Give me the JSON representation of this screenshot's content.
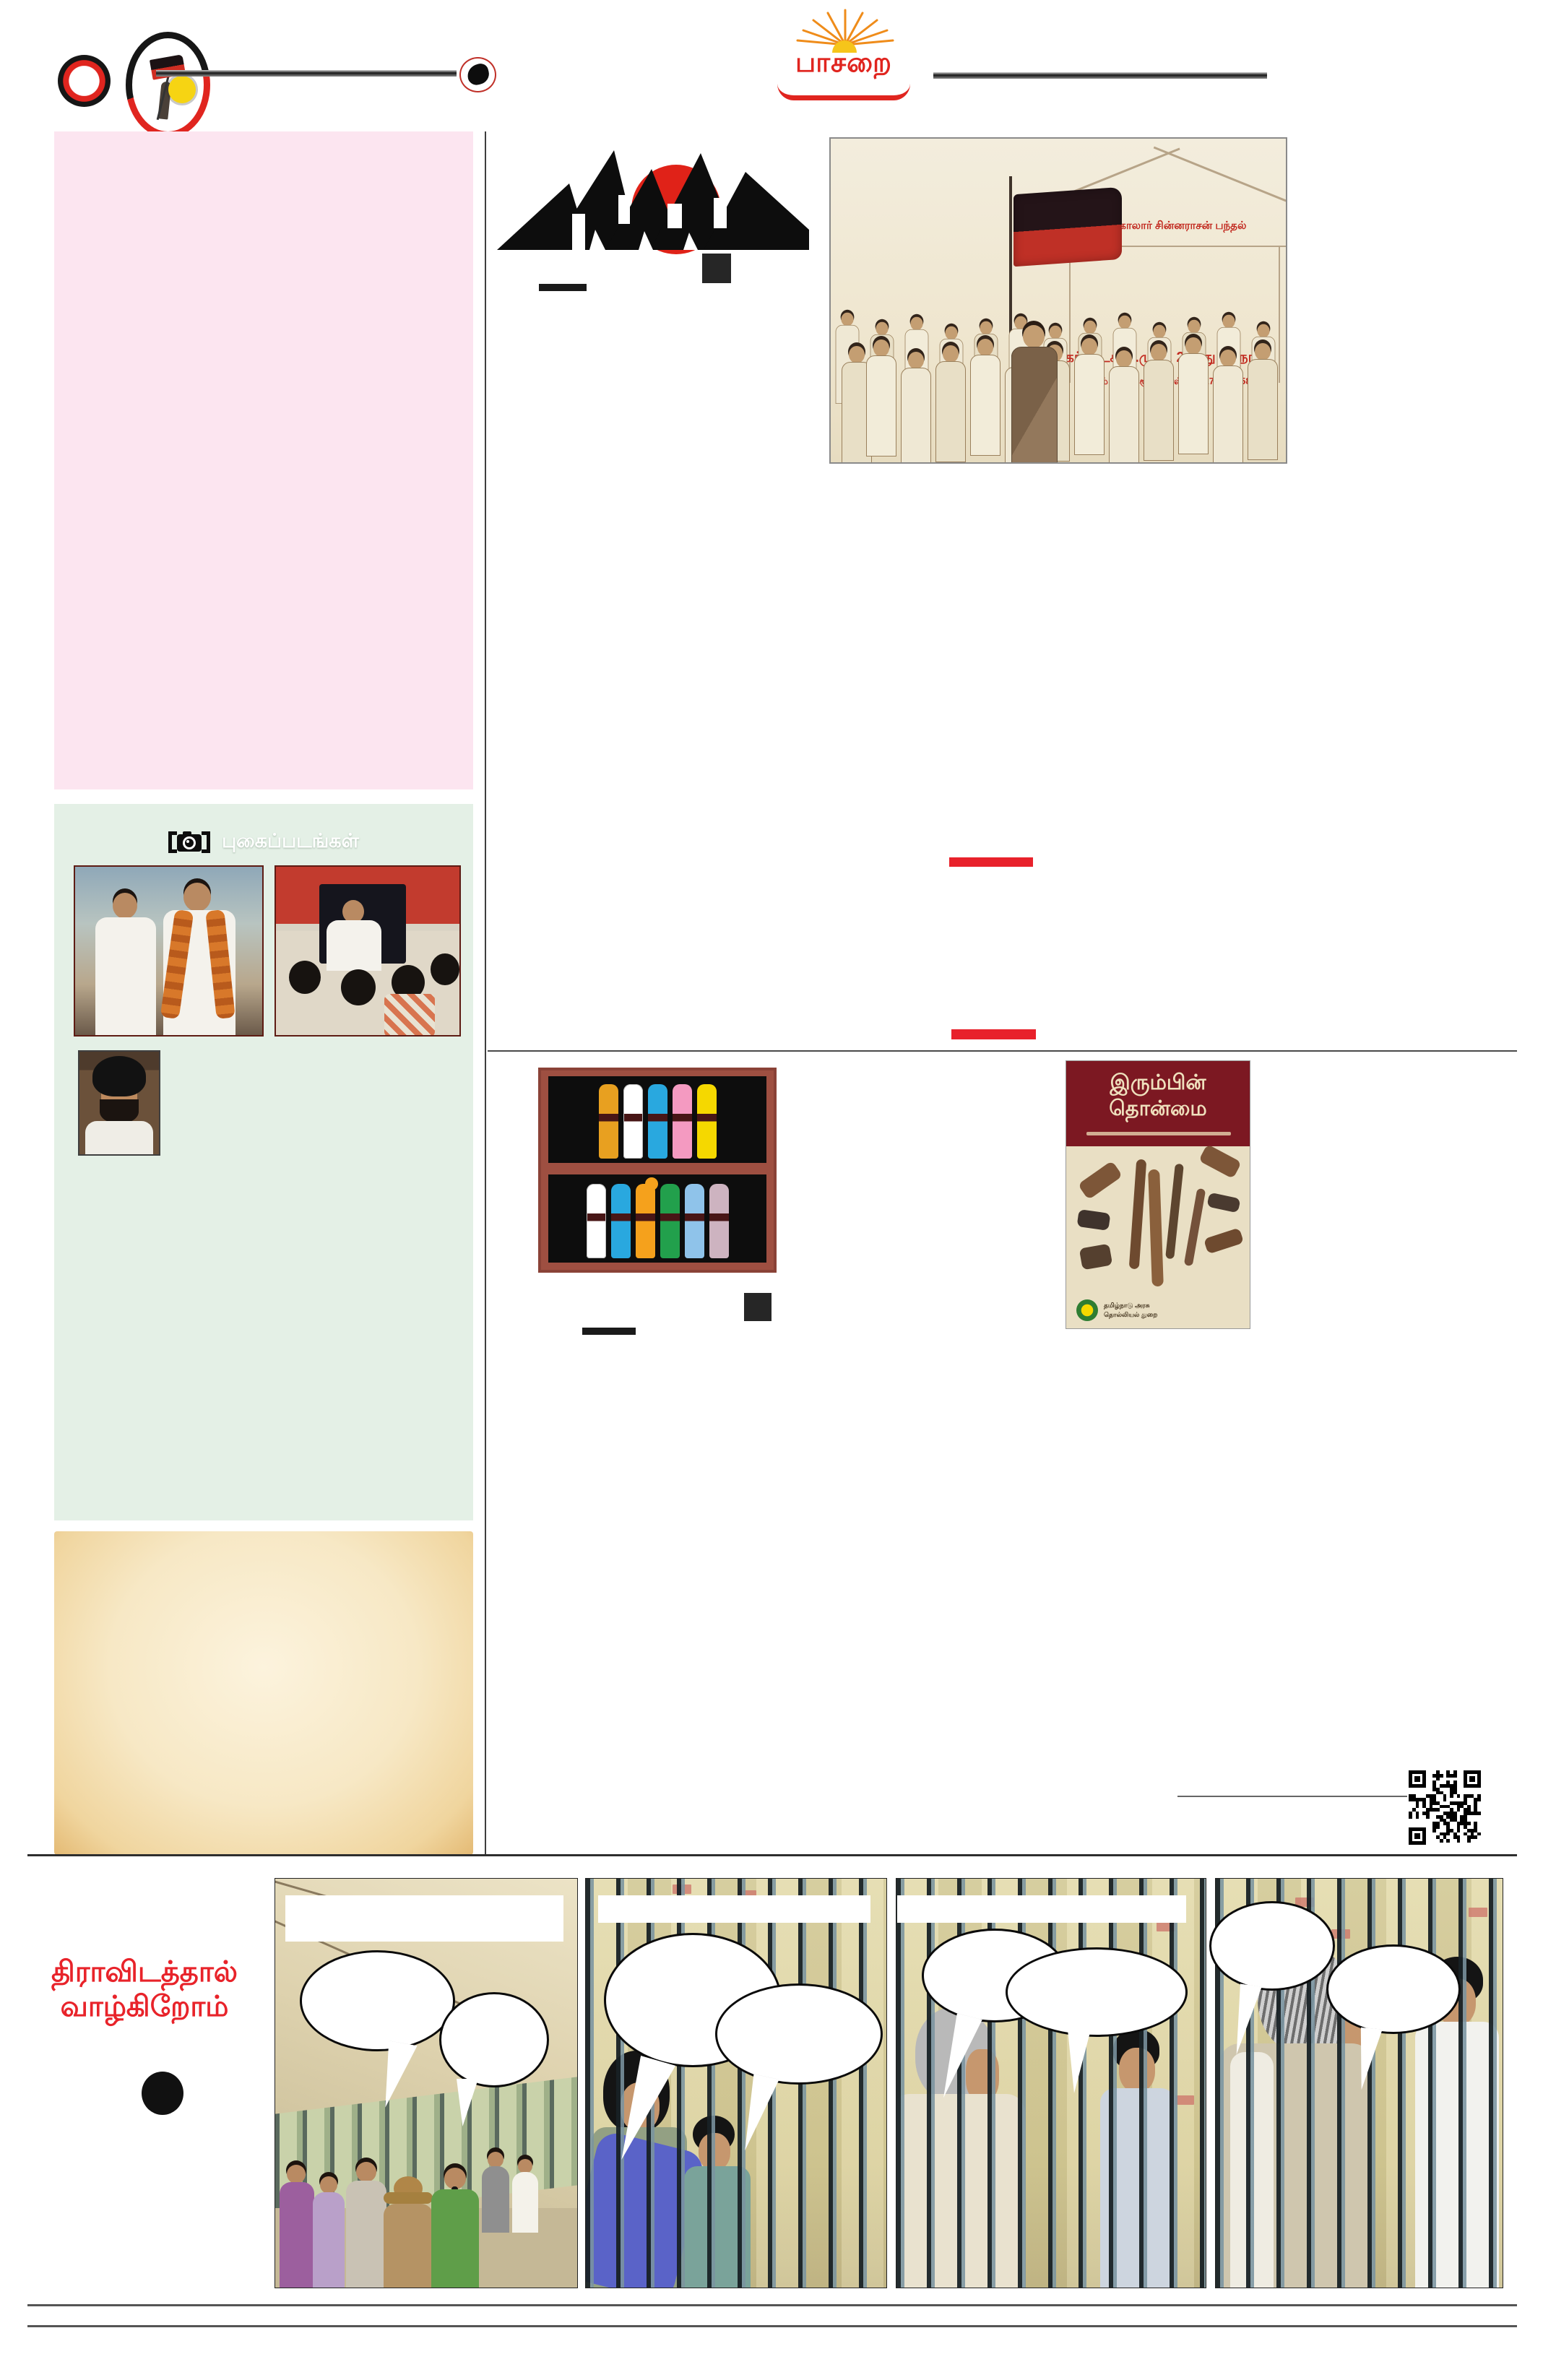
{
  "masthead": {
    "title": "பாசறை",
    "brand_red": "#e0251f",
    "sun_yellow": "#f6c51a",
    "ray_orange": "#ef8c1a"
  },
  "photos_section": {
    "icon": "camera-icon",
    "title": "புகைப்படங்கள்"
  },
  "conference_story": {
    "logo_title": "மாநாடு",
    "logo_red": "#e02218",
    "illustration": {
      "banner_top": "கோலார் சின்னராசன் பந்தல்",
      "banner_main": "கர்நாடக தி.மு.க. 2-வது மாநாடு",
      "banner_sub": "இடம்:பெங்களூரு,நாள்: 26, 27.04.1958",
      "text_red": "#c22a20"
    }
  },
  "pull_quote_accent": "#e8212b",
  "library_section": {
    "shelf_word_top": "பாசறை",
    "shelf_word_bottom": "படிப்பறை",
    "shelf1_colors": [
      "#e8a020",
      "#ffffff",
      "#29a8df",
      "#f49ac1",
      "#f5d800"
    ],
    "shelf2_colors": [
      "#ffffff",
      "#29a8df",
      "#f5a11c",
      "#22a04c",
      "#8fc3ea",
      "#cdb3c0"
    ]
  },
  "book_cover": {
    "title_line1": "இரும்பின்",
    "title_line2": "தொன்மை",
    "publisher_line1": "தமிழ்நாடு அரசு",
    "publisher_line2": "தொல்லியல் துறை",
    "header_maroon": "#7c1822"
  },
  "comic": {
    "title_line1": "திராவிடத்தால்",
    "title_line2": "வாழ்கிறோம்",
    "title_red": "#e8232a",
    "panel_count": 4,
    "speech_bubble_count": 8
  }
}
